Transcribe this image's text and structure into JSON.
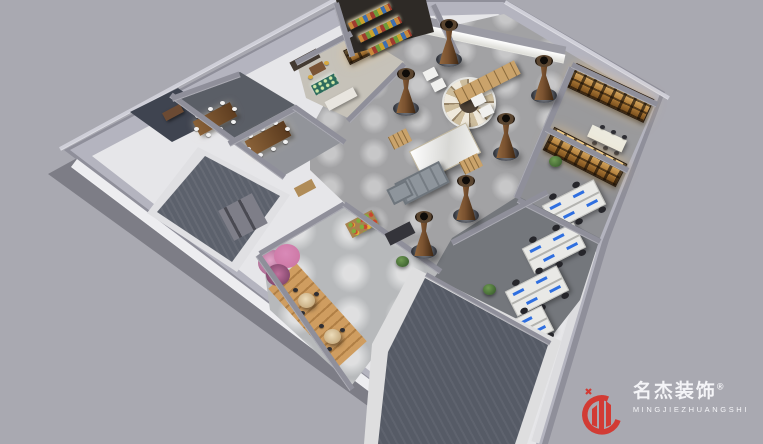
{
  "watermark": {
    "brand_cn": "名杰装饰",
    "registered_mark": "®",
    "brand_en": "MINGJIEZHUANGSHI"
  },
  "scene": {
    "type": "3d-office-floorplan-render",
    "areas": [
      "reception-lounge-hall",
      "meeting-room-1",
      "meeting-room-2",
      "pantry-bar",
      "market-shelves",
      "library-room-a",
      "library-room-b",
      "open-office",
      "cafe-break-room",
      "empty-carpet-room-1",
      "empty-carpet-room-2"
    ]
  },
  "colors": {
    "bg": "#a9a9b1",
    "wall": "#8f8f9a",
    "wall_light": "#cfcfd8",
    "floor_light": "#e6e6e9",
    "concrete": "#a2a2a4",
    "carpet": "#5c616c",
    "wood": "#c08f55",
    "cafe_floor": "#b7b9bb",
    "office_floor": "#74777c",
    "accent_red": "#d23b34",
    "glow_amber": "#f0bf72",
    "screen_blue": "#2f6fe0",
    "plant_green": "#3f6b33",
    "blossom_pink": "#c9729f",
    "column_brown": "#7a5230",
    "table_brown": "#77502f",
    "logo_text": "#f4f4f7"
  }
}
